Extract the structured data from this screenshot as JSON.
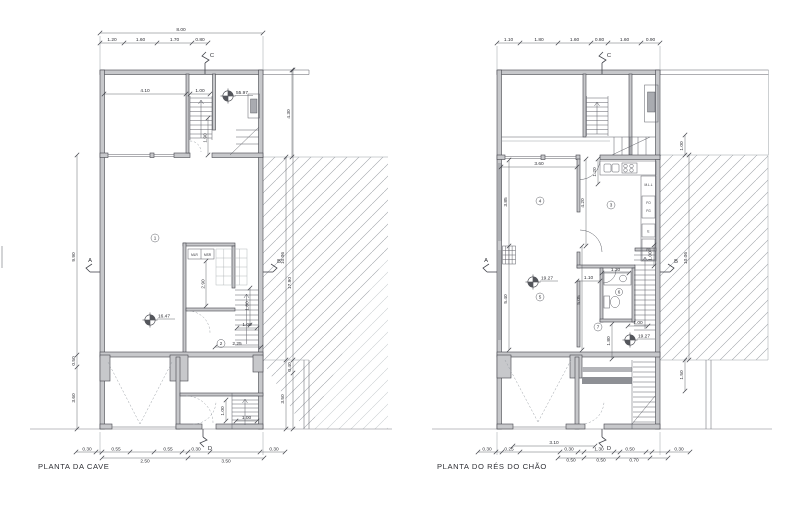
{
  "cave": {
    "title": "PLANTA DA CAVE",
    "markers": {
      "a": "A",
      "b": "B",
      "c": "C",
      "d": "D"
    },
    "levels": {
      "top_room": "55.97",
      "main_room": "16.47"
    },
    "rooms": {
      "main": "1",
      "hall": "2"
    },
    "laundry": {
      "left": "MLR",
      "right": "MSR"
    },
    "dims": {
      "total": "8.00",
      "top": [
        "1.20",
        "1.60",
        "1.70",
        "0.80"
      ],
      "room_w": "4.10",
      "stair_w": "1.00",
      "stair_run": "1.90",
      "laundry_h": "2.90",
      "stair_h": "1.80",
      "hall_w": "2.25",
      "hall_d": "1.00",
      "entry_h": "1.00",
      "entry_w": "1.00",
      "left": [
        "9.90",
        "0.50",
        "3.60"
      ],
      "right": [
        "4.30",
        "10.06",
        "17.90",
        "0.40",
        "3.50"
      ],
      "bottom": [
        "0.30",
        "0.55",
        "0.55",
        "0.30",
        "0.30"
      ],
      "bottom_lower": [
        "2.50",
        "3.50"
      ]
    }
  },
  "chao": {
    "title": "PLANTA DO RÉS DO CHÃO",
    "markers": {
      "a": "A",
      "b": "B",
      "c": "C",
      "d": "D"
    },
    "levels": {
      "main": "19.27",
      "entry": "19.27"
    },
    "rooms": {
      "kitchen": "3",
      "living": "4",
      "dining": "5",
      "bath": "6",
      "hall": "7"
    },
    "kitchen_labels": {
      "mll": "M.L.L",
      "fo": "FO",
      "fg": "FG",
      "e": "E",
      "fr": "FR"
    },
    "dims": {
      "top": [
        "1.10",
        "1.80",
        "1.60",
        "0.80",
        "1.60",
        "0.90"
      ],
      "living_w": "3.60",
      "living_h": "3.85",
      "dining_h": "5.40",
      "kitchen_h": "4.20",
      "kitchen_w": "1.20",
      "hall_w": "1.10",
      "hall_h": "5.05",
      "bath_w": "1.30",
      "bath_h": "1.80",
      "stair_w": "1.00",
      "stair_d": "1.00",
      "terrace": "1.00",
      "right_total": "10.06",
      "right_lower": "1.50",
      "bottom_upper": "3.10",
      "bottom": [
        "0.30",
        "0.25",
        "0.30",
        "1.30",
        "0.50",
        "0.30"
      ],
      "bottom_lower": [
        "0.50",
        "0.50",
        "0.70"
      ]
    }
  }
}
